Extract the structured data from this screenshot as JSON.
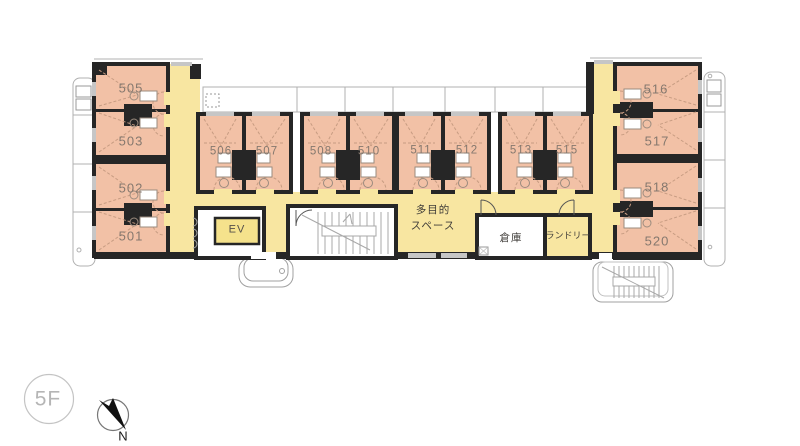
{
  "floor": {
    "label": "5F"
  },
  "compass": {
    "north_label": "N"
  },
  "rooms": {
    "left_wing": [
      {
        "label": "505"
      },
      {
        "label": "503"
      },
      {
        "label": "502"
      },
      {
        "label": "501"
      }
    ],
    "middle": [
      {
        "label": "506"
      },
      {
        "label": "507"
      },
      {
        "label": "508"
      },
      {
        "label": "510"
      },
      {
        "label": "511"
      },
      {
        "label": "512"
      },
      {
        "label": "513"
      },
      {
        "label": "515"
      }
    ],
    "right_wing": [
      {
        "label": "516"
      },
      {
        "label": "517"
      },
      {
        "label": "518"
      },
      {
        "label": "520"
      }
    ]
  },
  "facilities": {
    "elevator_label": "EV",
    "multipurpose_line1": "多目的",
    "multipurpose_line2": "スペース",
    "storage_label": "倉庫",
    "laundry_label": "ランドリー"
  },
  "colors": {
    "room_fill": "#f2c1a6",
    "corridor_fill": "#f8e6a1",
    "elevator_fill": "#f5e28c",
    "wall": "#262626"
  }
}
